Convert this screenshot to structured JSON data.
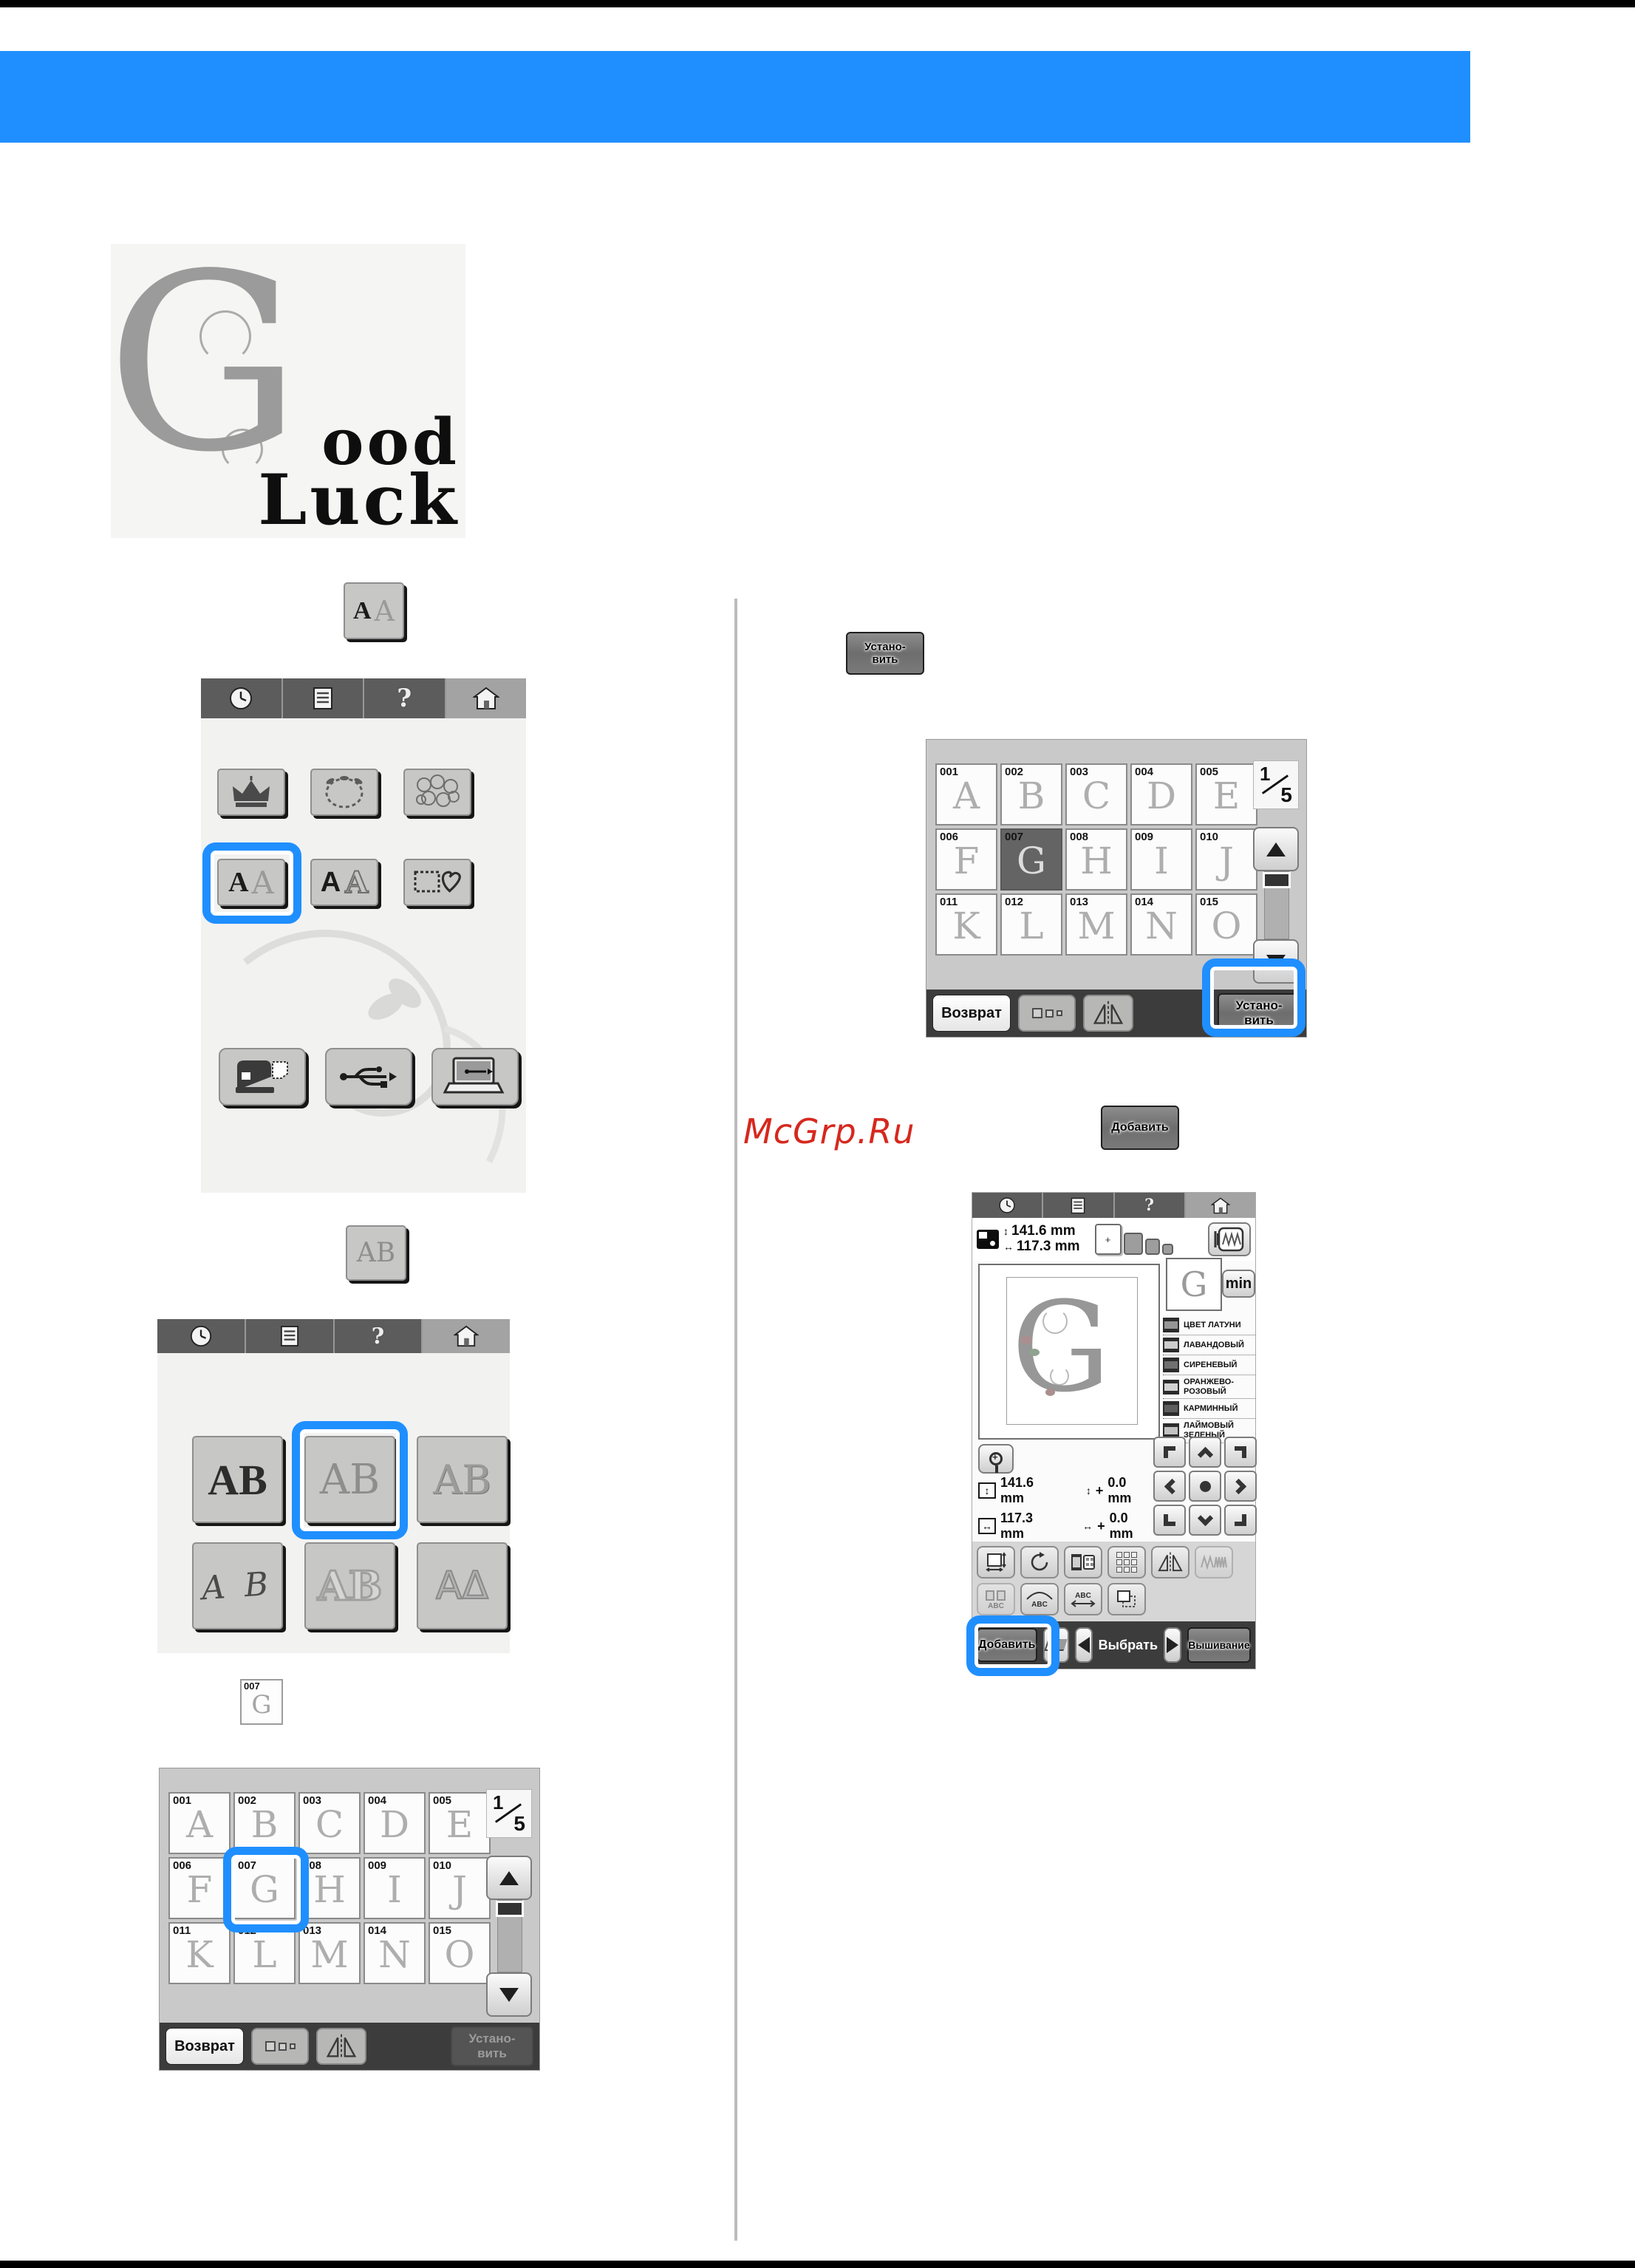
{
  "page": {
    "watermark": "McGrp.Ru",
    "accent_blue": "#1f8fff",
    "watermark_red": "#d6281e"
  },
  "sample": {
    "initial": "G",
    "word_top": "ood",
    "word_bottom": "Luck"
  },
  "icons": {
    "help_glyph": "?",
    "v_arrow": "↕",
    "h_arrow": "↔",
    "abc": "ABC",
    "min_plus": "+"
  },
  "mini_buttons": {
    "category": {
      "a_dark": "A",
      "a_light": "A"
    },
    "style": {
      "text": "AB"
    },
    "letter": {
      "num": "007",
      "glyph": "G"
    }
  },
  "screen1": {
    "alpha_deco": {
      "dark": "A",
      "light": "A"
    },
    "alpha_plain": {
      "dark": "A",
      "light": "A"
    }
  },
  "screen2": {
    "styles": [
      {
        "text": "AB",
        "kind": "serif"
      },
      {
        "text": "AB",
        "kind": "floral"
      },
      {
        "text": "AB",
        "kind": "ornate"
      },
      {
        "text": "A B",
        "kind": "script"
      },
      {
        "text": "AB",
        "kind": "outline"
      },
      {
        "text": "AΔ",
        "kind": "greek"
      }
    ]
  },
  "grid_common": {
    "page_current": "1",
    "page_total": "5",
    "return_label": "Возврат",
    "set_line1": "Устано-",
    "set_line2": "вить"
  },
  "grid_left": {
    "tiles": [
      {
        "num": "001",
        "glyph": "A",
        "state": ""
      },
      {
        "num": "002",
        "glyph": "B",
        "state": ""
      },
      {
        "num": "003",
        "glyph": "C",
        "state": ""
      },
      {
        "num": "004",
        "glyph": "D",
        "state": ""
      },
      {
        "num": "005",
        "glyph": "E",
        "state": ""
      },
      {
        "num": "006",
        "glyph": "F",
        "state": ""
      },
      {
        "num": "007",
        "glyph": "G",
        "state": ""
      },
      {
        "num": "008",
        "glyph": "H",
        "state": ""
      },
      {
        "num": "009",
        "glyph": "I",
        "state": ""
      },
      {
        "num": "010",
        "glyph": "J",
        "state": ""
      },
      {
        "num": "011",
        "glyph": "K",
        "state": ""
      },
      {
        "num": "012",
        "glyph": "L",
        "state": ""
      },
      {
        "num": "013",
        "glyph": "M",
        "state": ""
      },
      {
        "num": "014",
        "glyph": "N",
        "state": ""
      },
      {
        "num": "015",
        "glyph": "O",
        "state": ""
      }
    ]
  },
  "grid_right": {
    "tiles": [
      {
        "num": "001",
        "glyph": "A",
        "state": ""
      },
      {
        "num": "002",
        "glyph": "B",
        "state": ""
      },
      {
        "num": "003",
        "glyph": "C",
        "state": ""
      },
      {
        "num": "004",
        "glyph": "D",
        "state": ""
      },
      {
        "num": "005",
        "glyph": "E",
        "state": ""
      },
      {
        "num": "006",
        "glyph": "F",
        "state": ""
      },
      {
        "num": "007",
        "glyph": "G",
        "state": "selected"
      },
      {
        "num": "008",
        "glyph": "H",
        "state": ""
      },
      {
        "num": "009",
        "glyph": "I",
        "state": ""
      },
      {
        "num": "010",
        "glyph": "J",
        "state": ""
      },
      {
        "num": "011",
        "glyph": "K",
        "state": ""
      },
      {
        "num": "012",
        "glyph": "L",
        "state": ""
      },
      {
        "num": "013",
        "glyph": "M",
        "state": ""
      },
      {
        "num": "014",
        "glyph": "N",
        "state": ""
      },
      {
        "num": "015",
        "glyph": "O",
        "state": ""
      }
    ]
  },
  "set_button": {
    "line1": "Устано-",
    "line2": "вить"
  },
  "add_button": {
    "label": "Добавить"
  },
  "edit": {
    "size_w": "141.6 mm",
    "size_h": "117.3 mm",
    "offset_v": "0.0 mm",
    "offset_h": "0.0 mm",
    "plus": "+",
    "angle": "0°",
    "min_label": "min",
    "preview_glyph": "G",
    "thumb_glyph": "G",
    "colors": [
      {
        "name": "ЦВЕТ ЛАТУНИ",
        "shade": "#969696"
      },
      {
        "name": "ЛАВАНДОВЫЙ",
        "shade": "#cdcdcd"
      },
      {
        "name": "СИРЕНЕВЫЙ",
        "shade": "#707070"
      },
      {
        "name": "ОРАНЖЕВО-\nРОЗОВЫЙ",
        "shade": "#d2d2d2"
      },
      {
        "name": "КАРМИННЫЙ",
        "shade": "#5e5e5e"
      },
      {
        "name": "ЛАЙМОВЫЙ\nЗЕЛЕНЫЙ",
        "shade": "#c2c2c2"
      }
    ],
    "add_label": "Добавить",
    "select_label": "Выбрать",
    "embroider_label": "Вышивание"
  }
}
